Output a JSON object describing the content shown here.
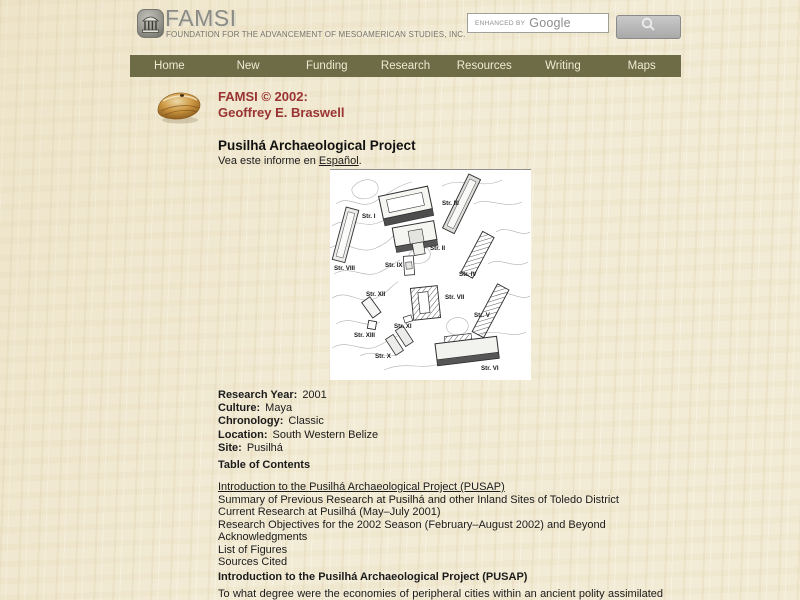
{
  "header": {
    "logo_title": "FAMSI",
    "logo_subtitle": "FOUNDATION FOR THE ADVANCEMENT OF MESOAMERICAN STUDIES, INC.",
    "search_prefix": "ENHANCED BY",
    "search_brand": "Google"
  },
  "nav": {
    "items": [
      "Home",
      "New",
      "Funding",
      "Research",
      "Resources",
      "Writing",
      "Maps"
    ]
  },
  "byline": {
    "line1": "FAMSI © 2002:",
    "line2": "Geoffrey E. Braswell"
  },
  "article": {
    "title": "Pusilhá Archaeological Project",
    "lang_prefix": "Vea este informe en ",
    "lang_link": "Español",
    "lang_suffix": "."
  },
  "map": {
    "description": "Pusilhá site map with contour lines and structures",
    "labels": [
      "Str. I",
      "Str. II",
      "Str. III",
      "Str. IV",
      "Str. V",
      "Str. VI",
      "Str. VII",
      "Str. VIII",
      "Str. IX",
      "Str. X",
      "Str. XI",
      "Str. XII",
      "Str. XIII"
    ]
  },
  "metadata": {
    "rows": [
      {
        "label": "Research Year:",
        "value": "2001"
      },
      {
        "label": "Culture:",
        "value": "Maya"
      },
      {
        "label": "Chronology:",
        "value": "Classic"
      },
      {
        "label": "Location:",
        "value": "South Western Belize"
      },
      {
        "label": "Site:",
        "value": "Pusilhá"
      }
    ]
  },
  "toc": {
    "heading": "Table of Contents",
    "items": [
      "Introduction to the Pusilhá Archaeological Project (PUSAP)",
      "Summary of Previous Research at Pusilhá and other Inland Sites of Toledo District",
      "Current Research at Pusilhá (May–July 2001)",
      "Research Objectives for the 2002 Season (February–August 2002) and Beyond",
      "Acknowledgments",
      "List of Figures",
      "Sources Cited"
    ]
  },
  "intro": {
    "heading": "Introduction to the Pusilhá Archaeological Project (PUSAP)",
    "body": "To what degree were the economies of peripheral cities within an ancient polity assimilated with"
  },
  "colors": {
    "accent_red": "#993333",
    "nav_bg": "#6e6b47",
    "nav_text": "#f0ead2",
    "page_bg": "#f2ebd5"
  }
}
